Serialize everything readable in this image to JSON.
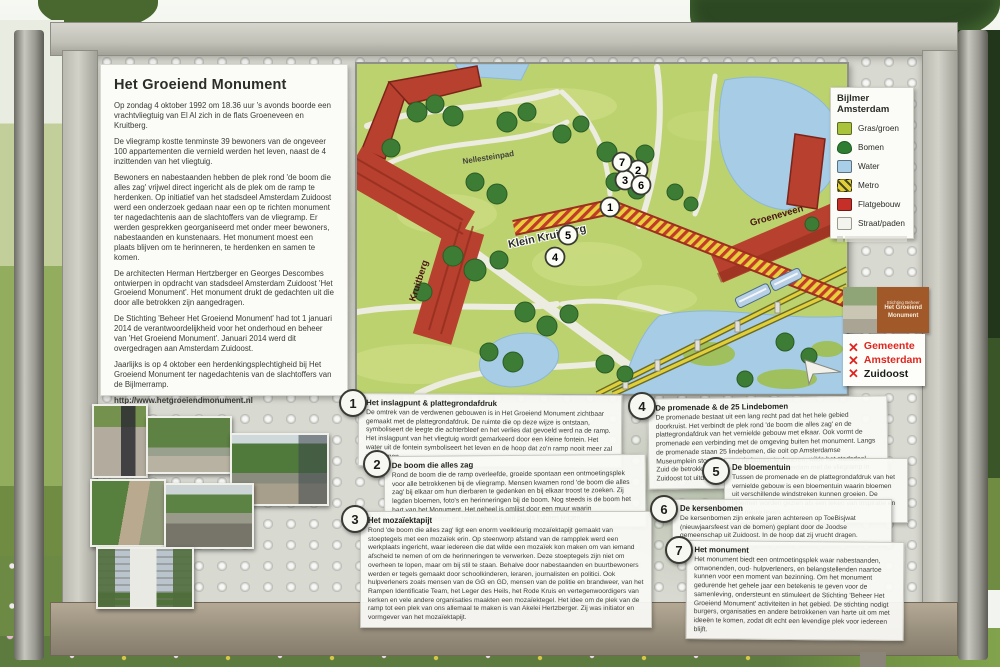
{
  "sign": {
    "info_card": {
      "title": "Het Groeiend Monument",
      "paragraphs": [
        "Op zondag 4 oktober 1992 om 18.36 uur 's avonds boorde een vrachtvliegtuig van El Al zich in de flats Groeneveen en Kruitberg.",
        "De vliegramp kostte tenminste 39 bewoners van de ongeveer 100 appartementen die vernield werden het leven, naast de 4 inzittenden van het vliegtuig.",
        "Bewoners en nabestaanden hebben de plek rond 'de boom die alles zag' vrijwel direct ingericht als de plek om de ramp te herdenken. Op initiatief van het stadsdeel Amsterdam Zuidoost werd een onderzoek gedaan naar een op te richten monument ter nagedachtenis aan de slachtoffers van de vliegramp. Er werden gesprekken georganiseerd met onder meer bewoners, nabestaanden en kunstenaars. Het monument moest een plaats blijven om te herinneren, te herdenken en samen te komen.",
        "De architecten Herman Hertzberger en Georges Descombes ontwierpen in opdracht van stadsdeel Amsterdam Zuidoost 'Het Groeiend Monument'. Het monument drukt de gedachten uit die door alle betrokken zijn aangedragen.",
        "De Stichting 'Beheer Het Groeiend Monument' had tot 1 januari 2014 de verantwoordelijkheid voor het onderhoud en beheer van 'Het Groeiend Monument'. Januari 2014 werd dit overgedragen aan Amsterdam Zuidoost.",
        "Jaarlijks is op 4 oktober een herdenkingsplechtigheid bij Het Groeiend Monument ter nagedachtenis van de slachtoffers van de Bijlmerramp."
      ],
      "url": "http://www.hetgroeiendmonument.nl"
    },
    "map": {
      "labels": {
        "path_name": "Nellesteinpad",
        "metro_name": "Klein Kruitberg",
        "building_left": "Kruitberg",
        "building_right": "Groeneveen"
      },
      "markers": [
        "1",
        "2",
        "3",
        "4",
        "5",
        "6",
        "7"
      ],
      "icons": [
        "metro-train-icon",
        "north-arrow-icon"
      ]
    },
    "legend": {
      "title": "Bijlmer Amsterdam",
      "items": [
        {
          "label": "Gras/groen",
          "color": "#a9c43c",
          "swatch": "square"
        },
        {
          "label": "Bomen",
          "color": "#2e7d32",
          "swatch": "tree"
        },
        {
          "label": "Water",
          "color": "#a9cfe8",
          "swatch": "square"
        },
        {
          "label": "Metro",
          "color": "#e3cf3a",
          "swatch": "striped"
        },
        {
          "label": "Flatgebouw",
          "color": "#c62f28",
          "swatch": "square"
        },
        {
          "label": "Straat/paden",
          "color": "#f4f4ee",
          "swatch": "square"
        }
      ]
    },
    "sections": [
      {
        "num": "1",
        "title": "Het inslagpunt & plattegrondafdruk",
        "body": "De omtrek van de verdwenen gebouwen is in Het Groeiend Monument zichtbaar gemaakt met de plattegrondafdruk. De ruimte die op deze wijze is ontstaan, symboliseert de leegte die achterbleef en het verlies dat gevoeld werd na de ramp. Het inslagpunt van het vliegtuig wordt gemarkeerd door een kleine fontein. Het water uit de fontein symboliseert het leven en de hoop dat zo'n ramp nooit meer zal voorkomen."
      },
      {
        "num": "2",
        "title": "De boom die alles zag",
        "body": "Rond de boom die de ramp overleefde, groeide spontaan een ontmoetingsplek voor alle betrokkenen bij de vliegramp. Mensen kwamen rond 'de boom die alles zag' bij elkaar om hun dierbaren te gedenken en bij elkaar troost te zoeken. Zij legden bloemen, foto's en herinneringen bij de boom. Nog steeds is de boom het hart van het Monument. Het geheel is omlijst door een muur waarin herdenkingsteksten en herinneringen een plaats kunnen krijgen."
      },
      {
        "num": "3",
        "title": "Het mozaïektapijt",
        "body": "Rond 'de boom die alles zag' ligt een enorm veelkleurig mozaïektapijt gemaakt van stoeptegels met een mozaïek erin. Op steenworp afstand van de rampplek werd een werkplaats ingericht, waar iedereen die dat wilde een mozaïek kon maken om van iemand afscheid te nemen of om de herinneringen te verwerken. Deze stoeptegels zijn niet om overheen te lopen, maar om bij stil te staan. Behalve door nabestaanden en buurtbewoners werden er tegels gemaakt door schoolkinderen, leraren, journalisten en politici. Ook hulpverleners zoals mensen van de GG en GD, mensen van de politie en brandweer, van het Rampen Identificatie Team, het Leger des Heils, het Rode Kruis en vertegenwoordigers van kerken en vele andere organisaties maakten een mozaïektegel. Het idee om de plek van de ramp tot een plek van ons allemaal te maken is van Akelei Hertzberger. Zij was initiator en vormgever van het mozaïektapijt."
      },
      {
        "num": "4",
        "title": "De promenade & de 25 Lindebomen",
        "body": "De promenade bestaat uit een lang recht pad dat het hele gebied doorkruist. Het verbindt de plek rond 'de boom die alles zag' en de plattegrondafdruk van het vernielde gebouw met elkaar. Ook vormt de promenade een verbinding met de omgeving buiten het monument. Langs de promenade staan 25 lindebomen, die ooit op Amsterdamse Museumplein stonden. Door de bomen te doneren, wilde het stadsdeel Zuid de betrokkenheid van de hele stad Amsterdam met de vliegramp in Zuidoost tot uitdrukking brengen."
      },
      {
        "num": "5",
        "title": "De bloementuin",
        "body": "Tussen de promenade en de plattegrondafdruk van het vernielde gebouw is een bloementuin waarin bloemen uit verschillende windstreken kunnen groeien. De bloemen worden gezien als een teken van inspiratie en van nieuw leven."
      },
      {
        "num": "6",
        "title": "De kersenbomen",
        "body": "De kersenbomen zijn enkele jaren achtereen op ToeBisjwat (nieuwjaarsfeest van de bomen) geplant door de Joodse gemeenschap uit Zuidoost. In de hoop dat zij vrucht dragen."
      },
      {
        "num": "7",
        "title": "Het monument",
        "body": "Het monument biedt een ontmoetingsplek waar nabestaanden, omwonenden, oud- hulpverleners, en belangstellenden naartoe kunnen voor een moment van bezinning. Om het monument gedurende het gehele jaar een betekenis te geven voor de samenleving, ondersteunt en stimuleert de Stichting 'Beheer Het Groeiend Monument' activiteiten in het gebied. De stichting nodigt burgers, organisaties en andere betrokkenen van harte uit om met ideeën te komen, zodat dit echt een levendige plek voor iedereen blijft."
      }
    ],
    "logos": {
      "stichting": {
        "lines": [
          "Stichting Beheer",
          "Het Groeiend",
          "Monument"
        ]
      },
      "gemeente": {
        "x_icon": "✕",
        "accent": "#e0251f",
        "lines": [
          "Gemeente",
          "Amsterdam",
          "Zuidoost"
        ]
      }
    },
    "photos": [
      "monument-mosaic-wall",
      "trees-over-mosaic",
      "promenade-with-flats",
      "wall-path",
      "promenade-wall",
      "white-flat-tower"
    ]
  }
}
